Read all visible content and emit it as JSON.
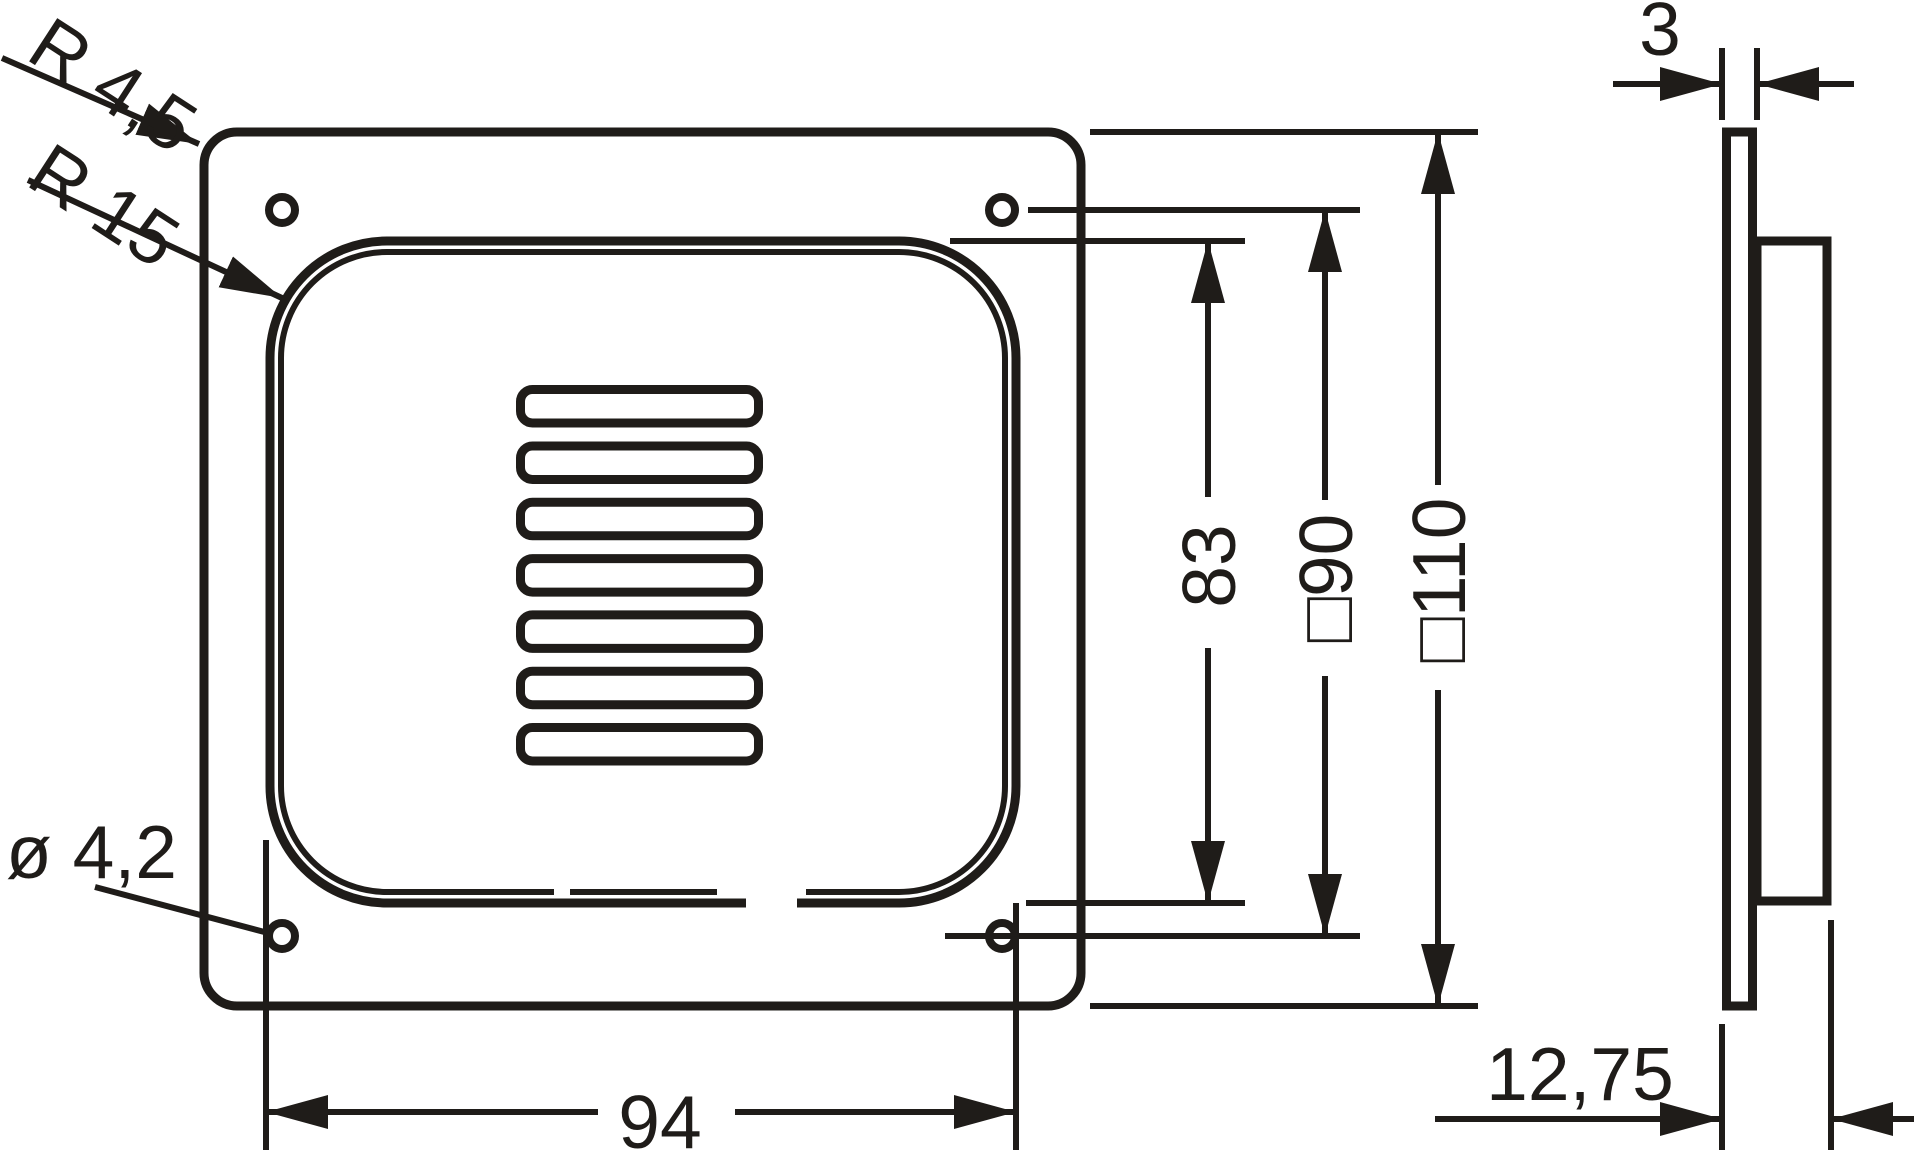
{
  "drawing": {
    "ink": "#1f1c19",
    "background": "#ffffff",
    "labels": {
      "corner_radius_outer": "R 4,5",
      "corner_radius_inner": "R 15",
      "hole_diameter": "ø 4,2",
      "hole_spacing_horizontal": "94",
      "recess_height": "83",
      "hole_spacing_vertical": "□90",
      "plate_size": "□110",
      "plate_thickness": "3",
      "total_depth": "12,75"
    }
  }
}
